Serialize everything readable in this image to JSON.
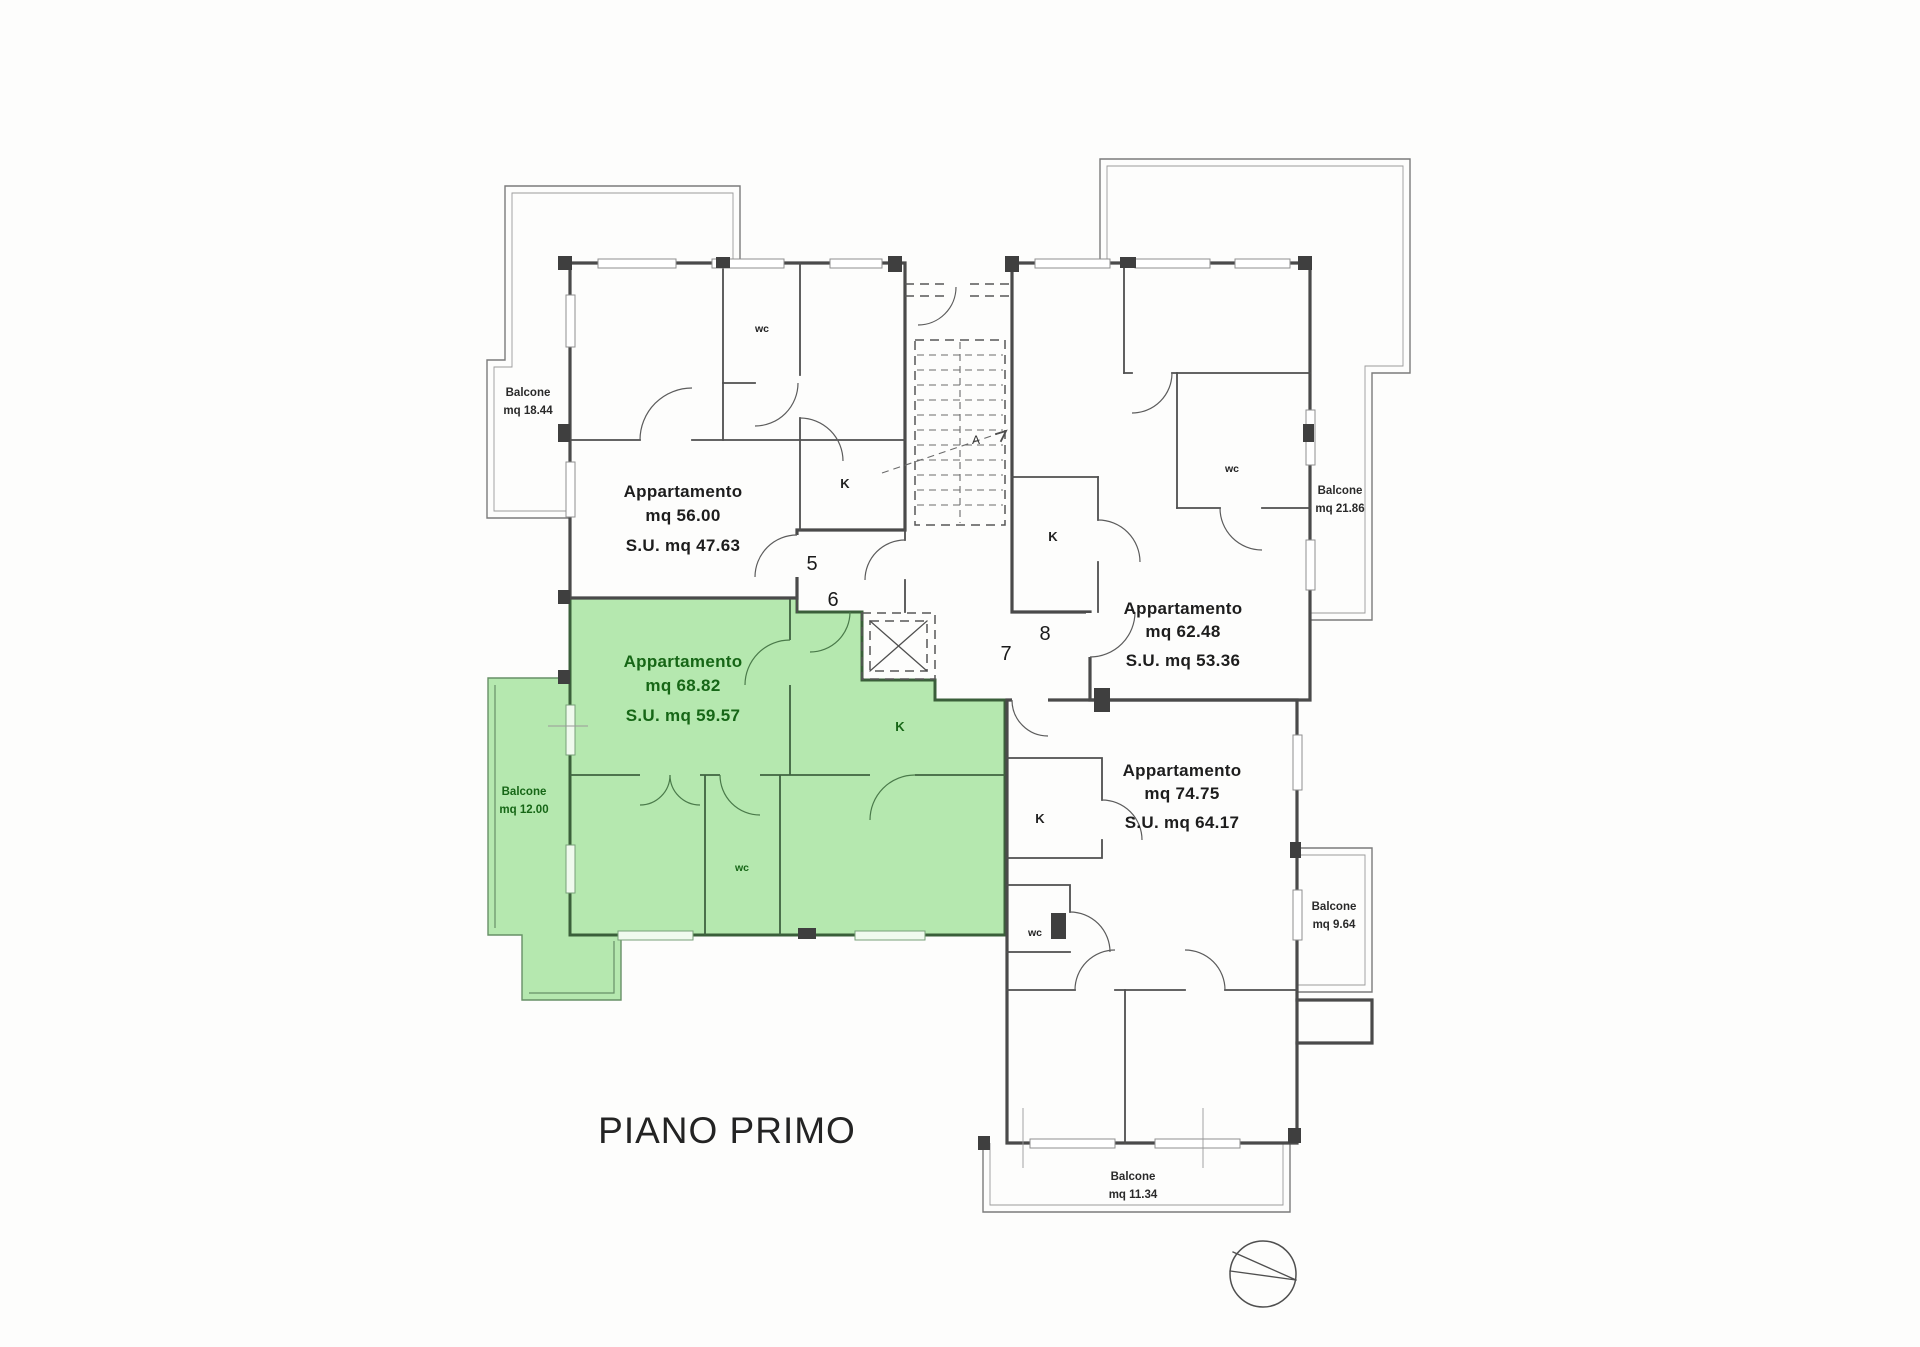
{
  "title": "PIANO PRIMO",
  "colors": {
    "highlight_fill": "#b5e8af",
    "highlight_text": "#166616",
    "wall": "#4a4a4a",
    "ink": "#1c1c1c"
  },
  "floor": {
    "apartments": [
      {
        "name": "Appartamento",
        "area": "mq 56.00",
        "surface": "S.U. mq 47.63",
        "kitchen": "K",
        "bath": "wc",
        "highlighted": false
      },
      {
        "name": "Appartamento",
        "area": "mq 62.48",
        "surface": "S.U. mq 53.36",
        "kitchen": "K",
        "bath": "wc",
        "highlighted": false
      },
      {
        "name": "Appartamento",
        "area": "mq 68.82",
        "surface": "S.U. mq 59.57",
        "kitchen": "K",
        "bath": "wc",
        "highlighted": true
      },
      {
        "name": "Appartamento",
        "area": "mq 74.75",
        "surface": "S.U. mq 64.17",
        "kitchen": "K",
        "bath": "wc",
        "highlighted": false
      }
    ],
    "balconies": [
      {
        "name": "Balcone",
        "area": "mq 18.44",
        "highlighted": false
      },
      {
        "name": "Balcone",
        "area": "mq 21.86",
        "highlighted": false
      },
      {
        "name": "Balcone",
        "area": "mq 12.00",
        "highlighted": true
      },
      {
        "name": "Balcone",
        "area": "mq 9.64",
        "highlighted": false
      },
      {
        "name": "Balcone",
        "area": "mq 11.34",
        "highlighted": false
      }
    ],
    "stair_markers": {
      "m5": "5",
      "m6": "6",
      "m7": "7",
      "m8": "8",
      "section": "A"
    }
  }
}
